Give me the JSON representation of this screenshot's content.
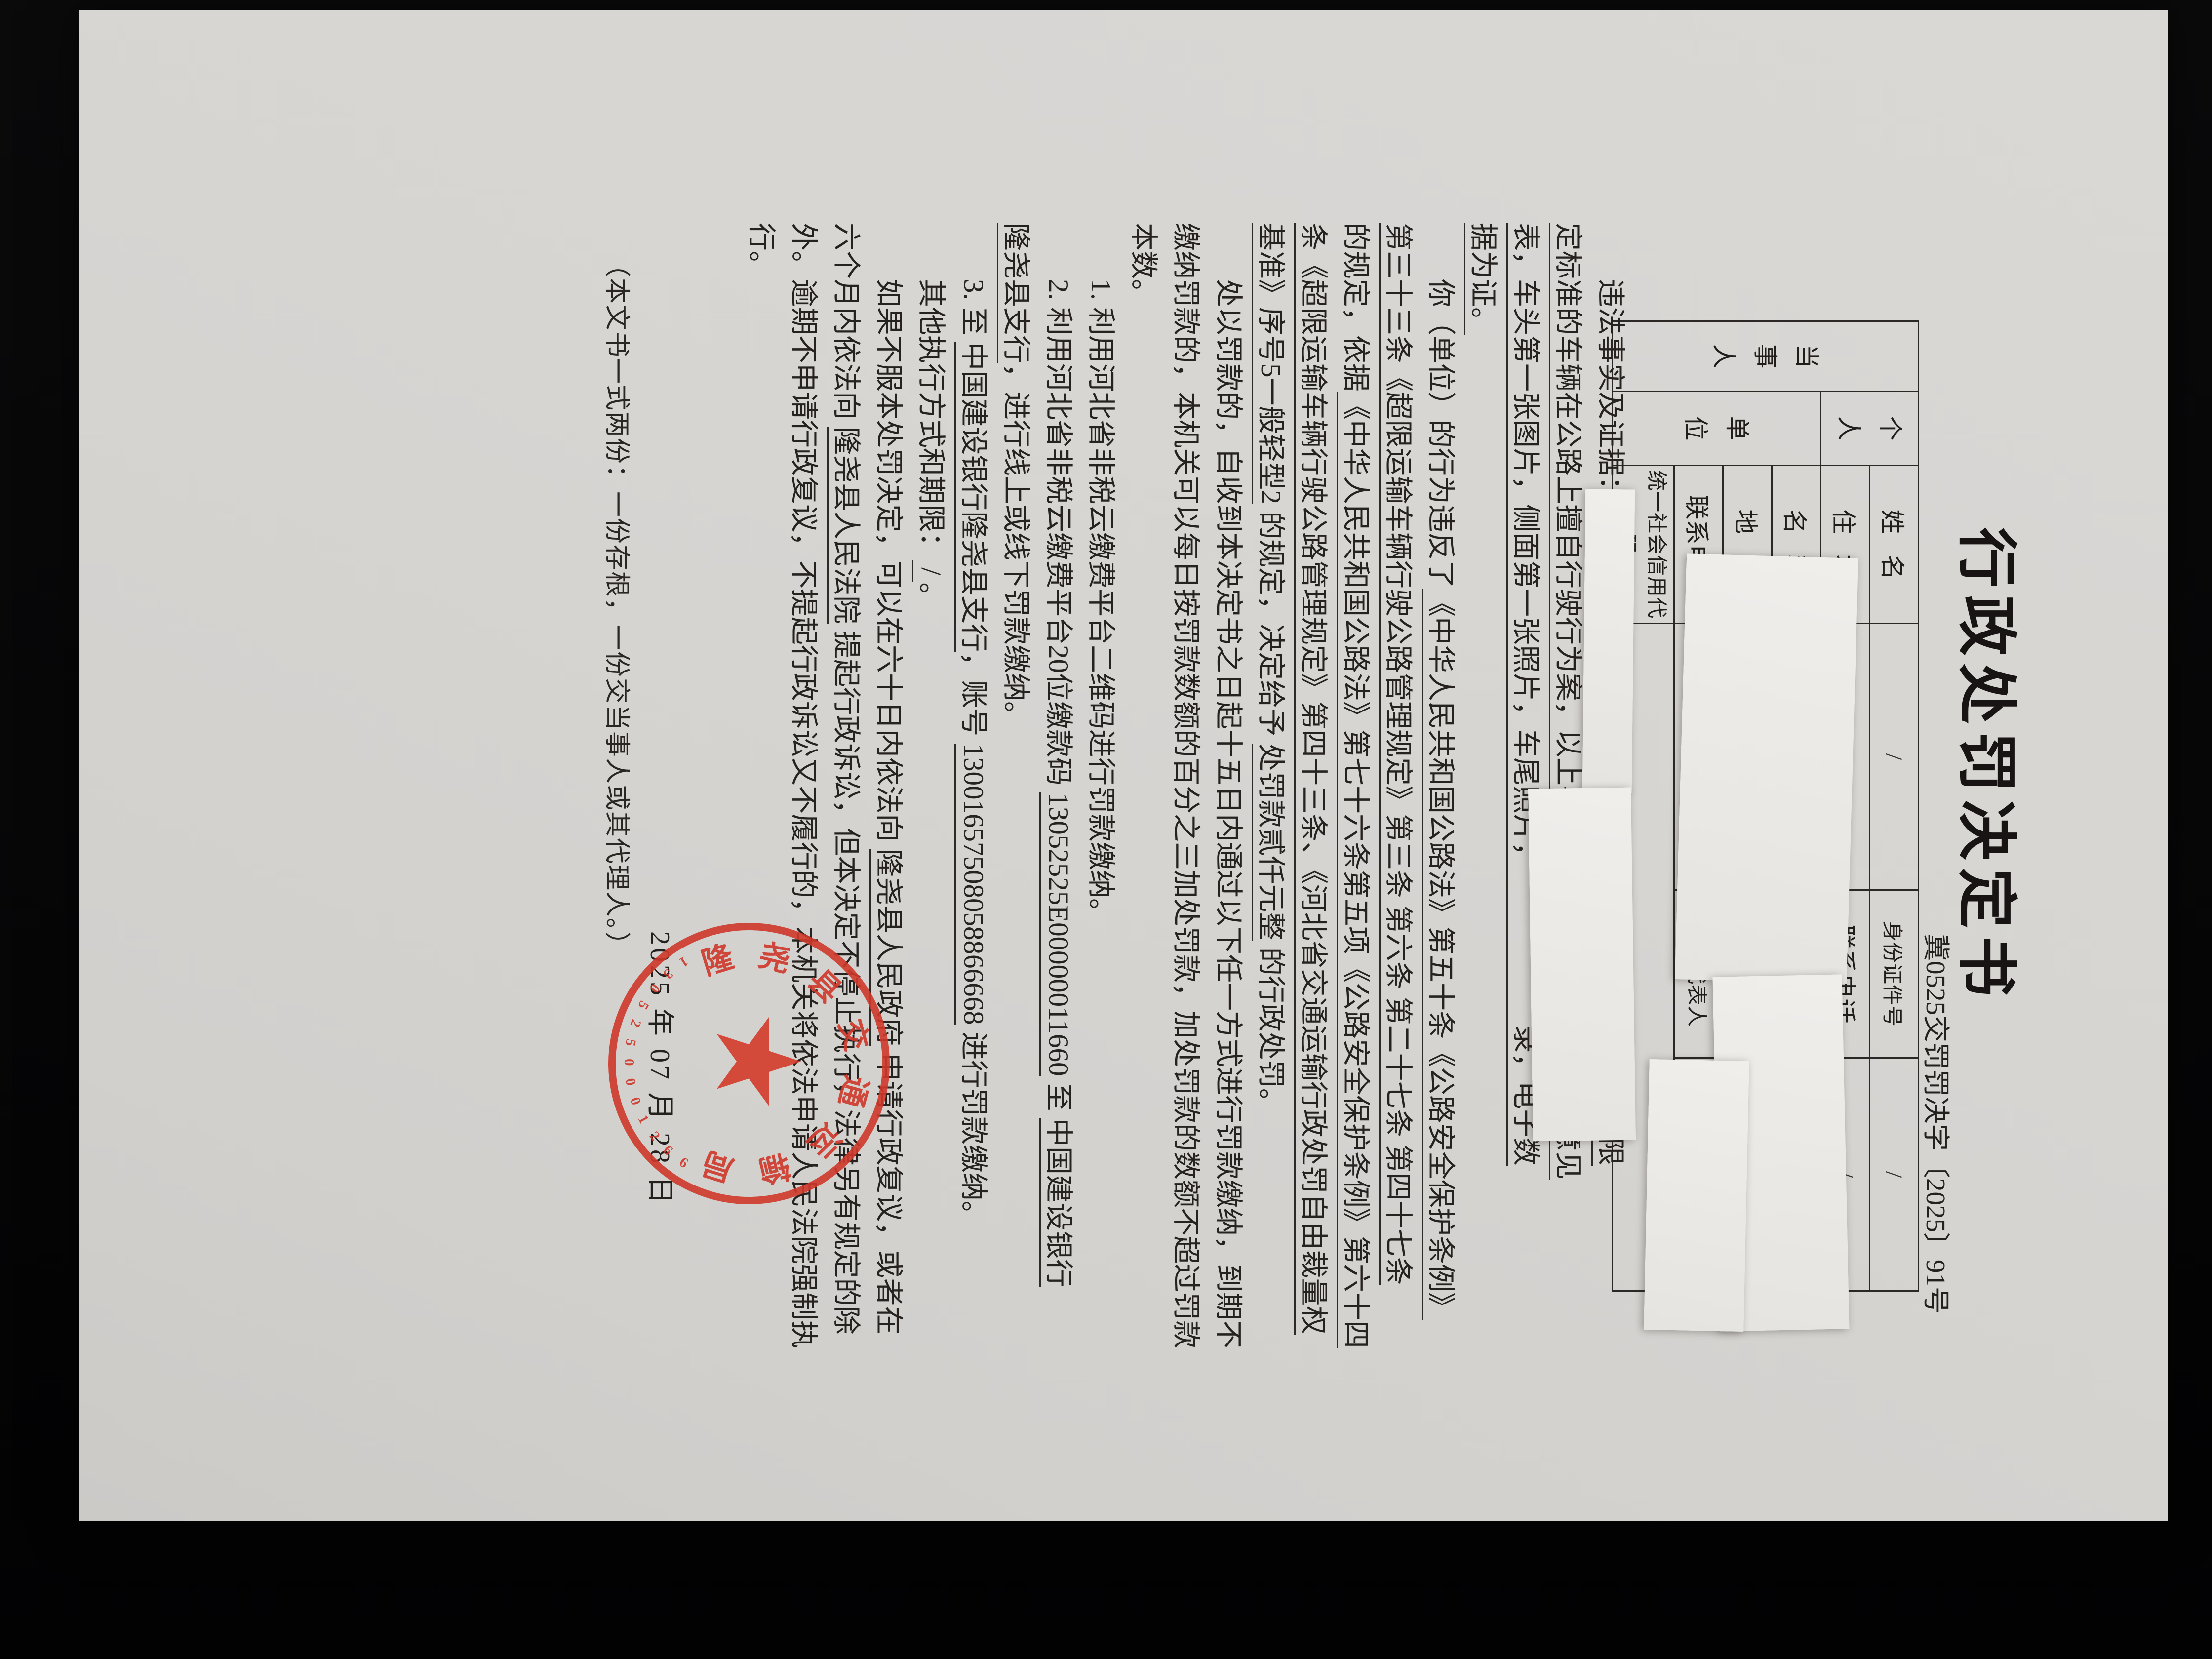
{
  "page": {
    "background": "#060607",
    "paper_color": "#d7d5d2",
    "ink_color": "#262220"
  },
  "title": "行政处罚决定书",
  "doc_number": "冀0525交罚罚决字〔2025〕91号",
  "party_table": {
    "party_label": "当事人",
    "person_label": "个人",
    "unit_label": "单位",
    "rows": [
      {
        "label": "姓名",
        "value": "/",
        "label2": "身份证件号",
        "value2": "/"
      },
      {
        "label": "住址",
        "value": "/",
        "label2": "联系电话",
        "value2": "/"
      },
      {
        "label": "名称",
        "value": ""
      },
      {
        "label": "地址",
        "value": ""
      },
      {
        "label": "联系电话",
        "value": "",
        "label2": "法定代表人",
        "value2": ""
      },
      {
        "label": "统一社会信用代码",
        "value": ""
      }
    ]
  },
  "body": {
    "lines": [
      {
        "ind": true,
        "segs": [
          {
            "t": "违法事实及证据：",
            "u": false
          },
          {
            "t": "　　　　　　　　　　　　　　　　　　量超过公路限",
            "u": true
          }
        ]
      },
      {
        "ind": false,
        "segs": [
          {
            "t": "定标准的车辆在公路上擅自行驶行为案，以上事实有　　　　　　实审核意见",
            "u": true
          }
        ]
      },
      {
        "ind": false,
        "segs": [
          {
            "t": "表，车头第一张图片，侧面第一张照片，车尾照片，　　　　　　录，电子数",
            "u": true
          }
        ]
      },
      {
        "ind": false,
        "segs": [
          {
            "t": "据为证。",
            "u": true
          }
        ]
      },
      {
        "ind": true,
        "segs": [
          {
            "t": "你（单位）的行为违反了",
            "u": false
          },
          {
            "t": "《中华人民共和国公路法》第五十条《公路安全保护条例》",
            "u": true
          }
        ]
      },
      {
        "ind": false,
        "segs": [
          {
            "t": "第三十三条《超限运输车辆行驶公路管理规定》第三条 第六条 第二十七条 第四十七条",
            "u": true
          }
        ]
      },
      {
        "ind": false,
        "segs": [
          {
            "t": "的规定，依据",
            "u": false
          },
          {
            "t": "《中华人民共和国公路法》第七十六条第五项《公路安全保护条例》第六十四",
            "u": true
          }
        ]
      },
      {
        "ind": false,
        "segs": [
          {
            "t": "条《超限运输车辆行驶公路管理规定》第四十三条、《河北省交通运输行政处罚自由裁量权",
            "u": true
          }
        ]
      },
      {
        "ind": false,
        "segs": [
          {
            "t": "基准》序号5一般轻型2",
            "u": true
          },
          {
            "t": " 的规定，决定给予 ",
            "u": false
          },
          {
            "t": "处罚款贰仟元整",
            "u": true
          },
          {
            "t": " 的行政处罚。",
            "u": false
          }
        ]
      },
      {
        "ind": true,
        "segs": [
          {
            "t": "处以罚款的，自收到本决定书之日起十五日内通过以下任一方式进行罚款缴纳，到期不",
            "u": false
          }
        ]
      },
      {
        "ind": false,
        "segs": [
          {
            "t": "缴纳罚款的，本机关可以每日按罚款数额的百分之三加处罚款，加处罚款的数额不超过罚款",
            "u": false
          }
        ]
      },
      {
        "ind": false,
        "segs": [
          {
            "t": "本数。",
            "u": false
          }
        ]
      },
      {
        "ind": true,
        "segs": [
          {
            "t": "1. 利用河北省非税云缴费平台二维码进行罚款缴纳。",
            "u": false
          }
        ]
      },
      {
        "ind": true,
        "segs": [
          {
            "t": "2. 利用河北省非税云缴费平台20位缴款码 ",
            "u": false
          },
          {
            "t": "13052525E00000011660",
            "u": true
          },
          {
            "t": " 至 ",
            "u": false
          },
          {
            "t": "中国建设银行",
            "u": true
          }
        ]
      },
      {
        "ind": false,
        "segs": [
          {
            "t": "隆尧县支行",
            "u": true
          },
          {
            "t": "，进行线上或线下罚款缴纳。",
            "u": false
          }
        ]
      },
      {
        "ind": true,
        "segs": [
          {
            "t": "3. 至 ",
            "u": false
          },
          {
            "t": "中国建设银行隆尧县支行",
            "u": true
          },
          {
            "t": "，账号 ",
            "u": false
          },
          {
            "t": "13001657508058866668",
            "u": true
          },
          {
            "t": " 进行罚款缴纳。",
            "u": false
          }
        ]
      },
      {
        "ind": true,
        "segs": [
          {
            "t": "其他执行方式和期限：",
            "u": false
          },
          {
            "t": " / ",
            "u": true
          },
          {
            "t": "。",
            "u": false
          }
        ]
      },
      {
        "ind": true,
        "segs": [
          {
            "t": "如果不服本处罚决定，可以在六十日内依法向 ",
            "u": false
          },
          {
            "t": "隆尧县人民政府",
            "u": true
          },
          {
            "t": " 申请行政复议，或者在",
            "u": false
          }
        ]
      },
      {
        "ind": false,
        "segs": [
          {
            "t": "六个月内依法向 ",
            "u": false
          },
          {
            "t": "隆尧县人民法院",
            "u": true
          },
          {
            "t": " 提起行政诉讼，但本决定不停止执行，法律另有规定的除",
            "u": false
          }
        ]
      },
      {
        "ind": false,
        "segs": [
          {
            "t": "外。逾期不申请行政复议，不提起行政诉讼又不履行的，本机关将依法申请人民法院强制执",
            "u": false
          }
        ]
      },
      {
        "ind": false,
        "segs": [
          {
            "t": "行。",
            "u": false
          }
        ]
      }
    ]
  },
  "date_line": "2025 年 07 月 28 日",
  "footer_note": "（本文书一式两份：一份存根，一份交当事人或其代理人。）",
  "stamp": {
    "org": "隆尧县交通运输局",
    "serial": "1305250001266",
    "star": "★",
    "color": "#cf392a"
  }
}
